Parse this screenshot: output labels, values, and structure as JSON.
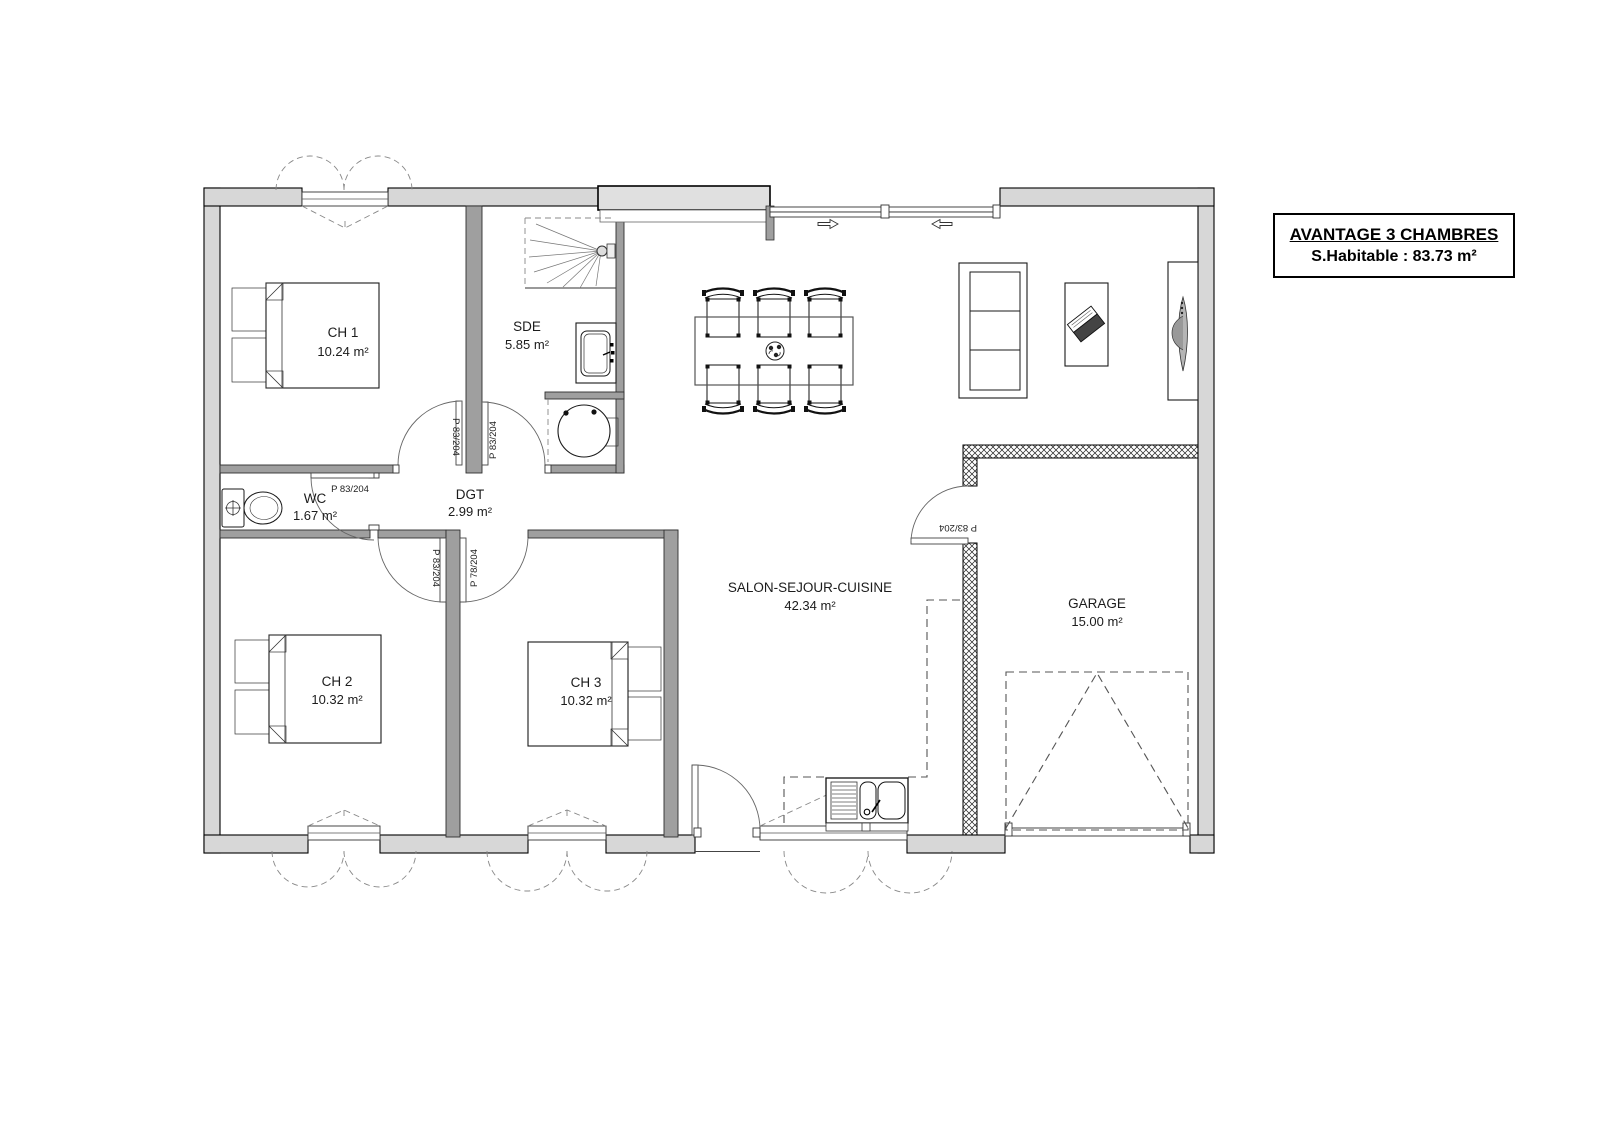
{
  "title_block": {
    "title": "AVANTAGE 3 CHAMBRES",
    "subtitle": "S.Habitable : 83.73 m²"
  },
  "rooms": {
    "ch1": {
      "name": "CH 1",
      "area": "10.24 m²"
    },
    "sde": {
      "name": "SDE",
      "area": "5.85 m²"
    },
    "wc": {
      "name": "WC",
      "area": "1.67 m²"
    },
    "dgt": {
      "name": "DGT",
      "area": "2.99 m²"
    },
    "ch2": {
      "name": "CH 2",
      "area": "10.32 m²"
    },
    "ch3": {
      "name": "CH 3",
      "area": "10.32 m²"
    },
    "salon": {
      "name": "SALON-SEJOUR-CUISINE",
      "area": "42.34 m²"
    },
    "garage": {
      "name": "GARAGE",
      "area": "15.00 m²"
    }
  },
  "doors": {
    "wc": {
      "label": "P 83/204"
    },
    "ch1": {
      "label": "P 83/204"
    },
    "sde": {
      "label": "P 83/204"
    },
    "ch2": {
      "label": "P 83/204"
    },
    "ch3": {
      "label": "P 78/204"
    },
    "garage": {
      "label": "P 83/204"
    }
  },
  "colors": {
    "exterior_wall": "#d7d7d7",
    "interior_wall": "#9f9f9f",
    "line": "#000000",
    "background": "#ffffff"
  }
}
